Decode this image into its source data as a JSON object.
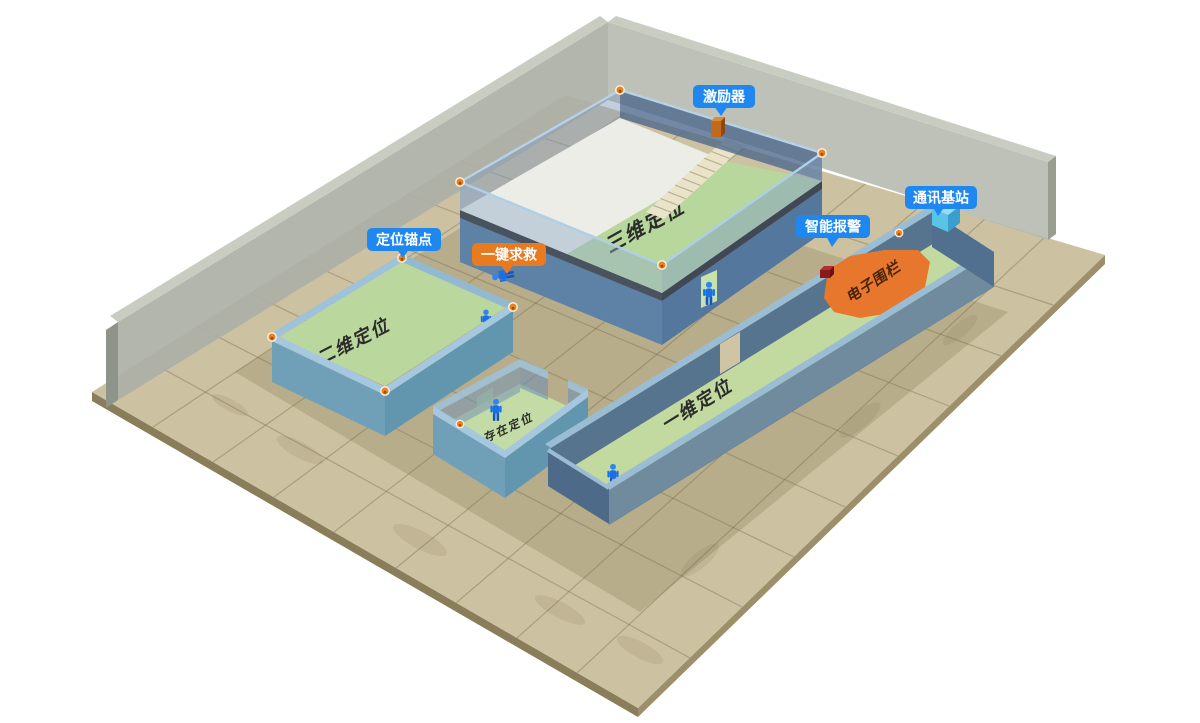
{
  "callouts": {
    "exciter": {
      "label": "激励器"
    },
    "comm_base": {
      "label": "通讯基站"
    },
    "smart_alarm": {
      "label": "智能报警"
    },
    "anchor_point": {
      "label": "定位锚点"
    },
    "sos": {
      "label": "一键求救"
    }
  },
  "zones": {
    "zone_3d": {
      "label": "三维定位"
    },
    "zone_2d": {
      "label": "二维定位"
    },
    "presence": {
      "label": "存在定位"
    },
    "zone_1d": {
      "label": "一维定位"
    },
    "fence": {
      "label": "电子围栏"
    }
  },
  "colors": {
    "callout_blue": "#1E88F0",
    "callout_orange": "#E87A20",
    "fence_orange": "#E8772E",
    "room_green": "#B7D79C",
    "corridor_green": "#C2D99F",
    "floor_tan": "#CCC1A1",
    "wall_blue": "#5E81A6",
    "back_wall_grey": "#ACB0A2",
    "person_blue": "#1A6FE8",
    "anchor_orange": "#E8831F"
  },
  "counts": {
    "anchor_dots_visible": 11,
    "people_standing": 4,
    "people_fallen": 1
  }
}
